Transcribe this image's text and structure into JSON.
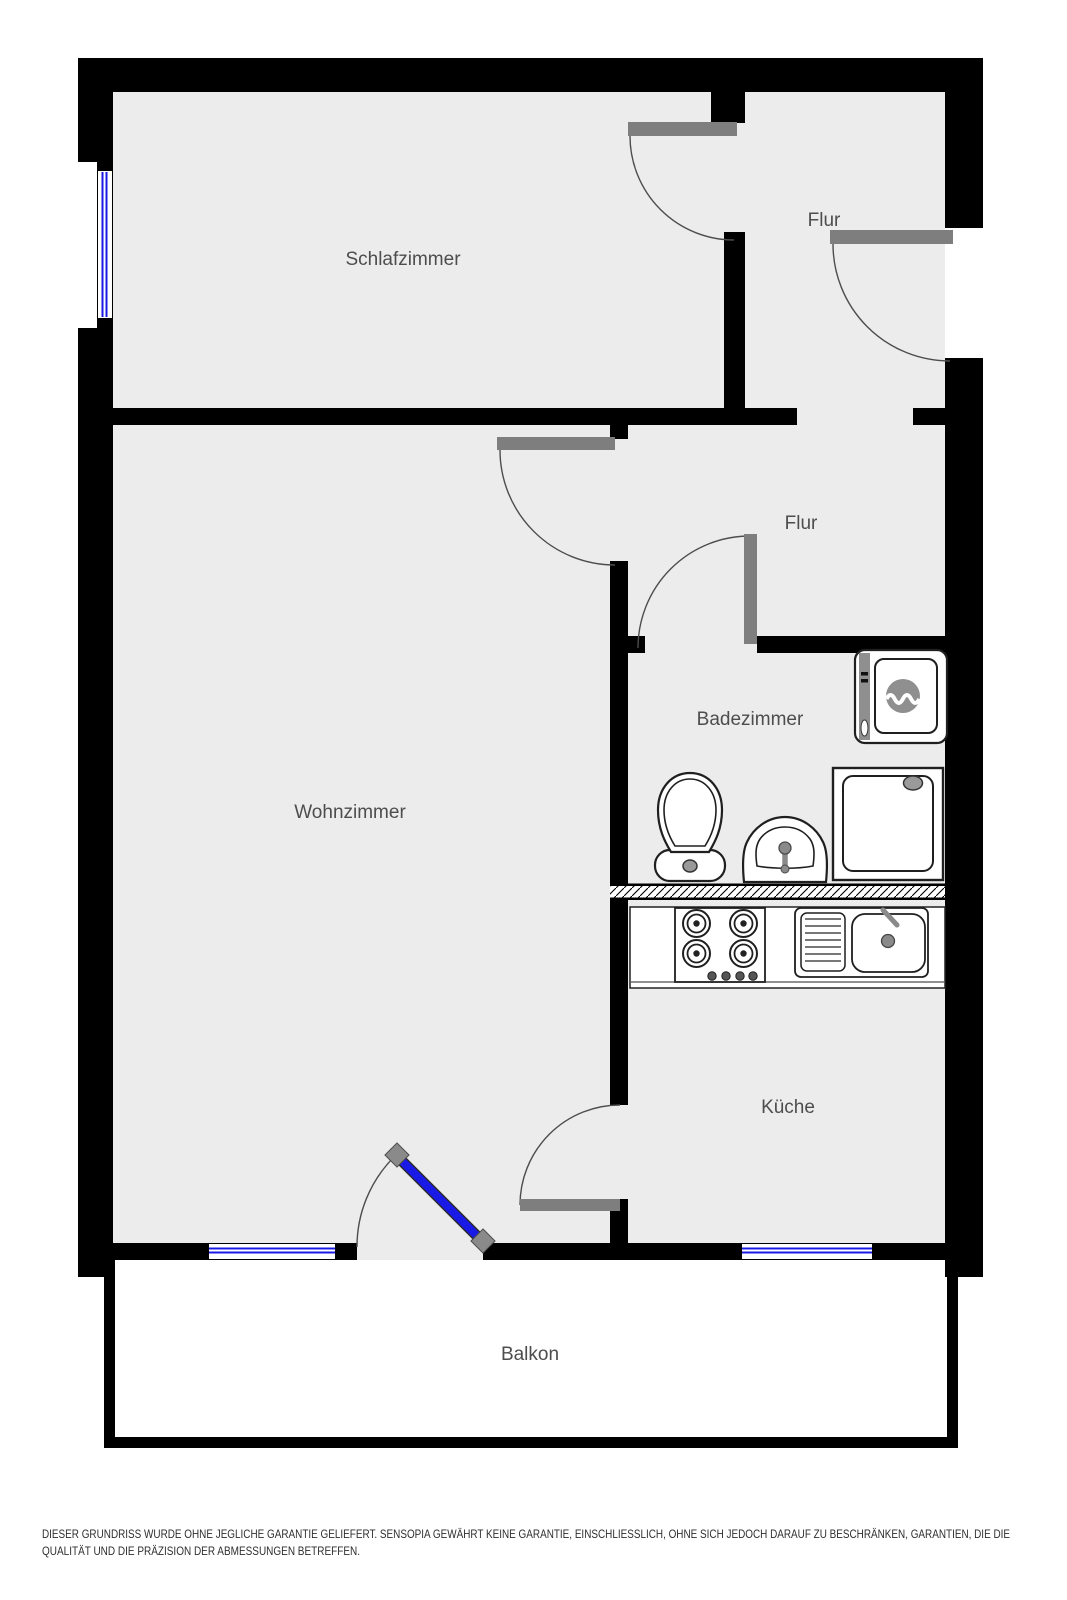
{
  "rooms": {
    "schlafzimmer": {
      "label": "Schlafzimmer"
    },
    "flur_oben": {
      "label": "Flur"
    },
    "flur_unten": {
      "label": "Flur"
    },
    "wohnzimmer": {
      "label": "Wohnzimmer"
    },
    "badezimmer": {
      "label": "Badezimmer"
    },
    "kueche": {
      "label": "Küche"
    },
    "balkon": {
      "label": "Balkon"
    }
  },
  "fixtures": {
    "badezimmer": [
      "toilet",
      "sink",
      "shower",
      "washing-machine"
    ],
    "kueche": [
      "stove",
      "kitchen-sink"
    ]
  },
  "disclaimer": {
    "line1": "DIESER GRUNDRISS WURDE OHNE JEGLICHE GARANTIE GELIEFERT. SENSOPIA GEWÄHRT KEINE GARANTIE, EINSCHLIESSLICH, OHNE SICH JEDOCH DARAUF ZU BESCHRÄNKEN, GARANTIEN, DIE DIE",
    "line2": "QUALITÄT UND DIE PRÄZISION DER ABMESSUNGEN BETREFFEN."
  },
  "colors": {
    "wall": "#000000",
    "room_fill": "#ececec",
    "door_leaf": "#7e7e7e",
    "door_arc": "#4d4d4d",
    "window_glass": "#1a1ae6",
    "fixture_outline": "#1f1f1f",
    "fixture_gray": "#8f8f8f",
    "label_text": "#4d4d4d",
    "disclaimer_text": "#2e2e2e",
    "balcony_fill": "#ffffff"
  }
}
